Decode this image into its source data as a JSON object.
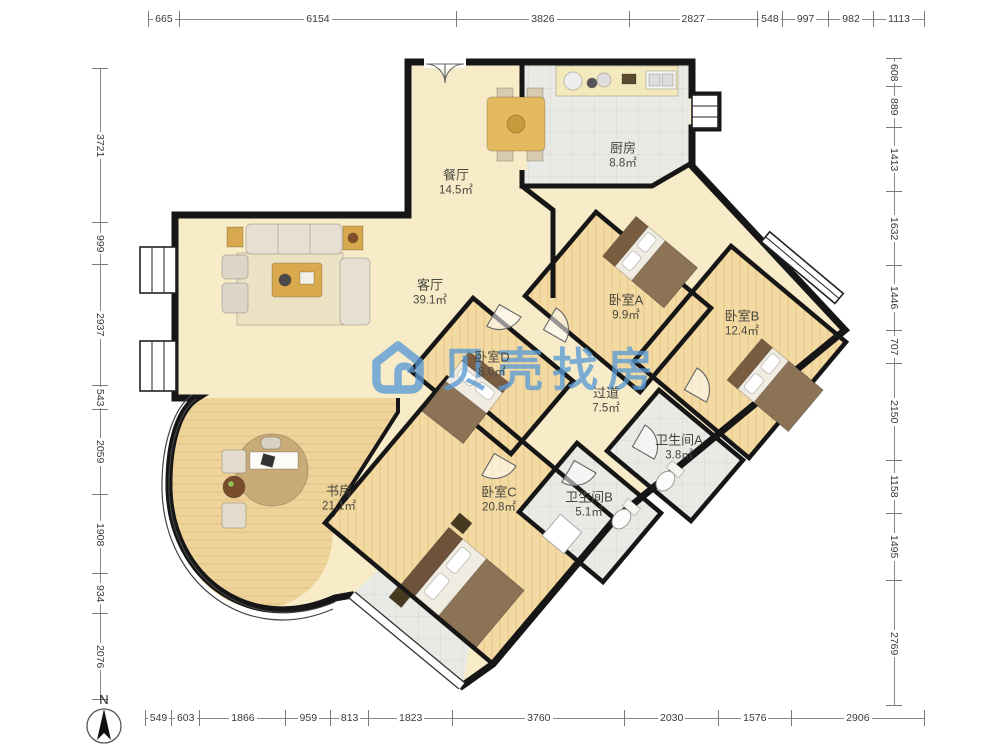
{
  "watermark": {
    "text": "贝壳找房",
    "color": "#5a9bd5"
  },
  "compass": {
    "label": "N"
  },
  "rooms": [
    {
      "id": "dining",
      "name": "餐厅",
      "area": "14.5㎡"
    },
    {
      "id": "kitchen",
      "name": "厨房",
      "area": "8.8㎡"
    },
    {
      "id": "living",
      "name": "客厅",
      "area": "39.1㎡"
    },
    {
      "id": "bedroomA",
      "name": "卧室A",
      "area": "9.9㎡"
    },
    {
      "id": "bedroomB",
      "name": "卧室B",
      "area": "12.4㎡"
    },
    {
      "id": "bedroomD",
      "name": "卧室D",
      "area": "8.0㎡"
    },
    {
      "id": "hallway",
      "name": "过道",
      "area": "7.5㎡"
    },
    {
      "id": "bathA",
      "name": "卫生间A",
      "area": "3.8㎡"
    },
    {
      "id": "bathB",
      "name": "卫生间B",
      "area": "5.1㎡"
    },
    {
      "id": "bedroomC",
      "name": "卧室C",
      "area": "20.8㎡"
    },
    {
      "id": "study",
      "name": "书房",
      "area": "21.1㎡"
    }
  ],
  "rulers": {
    "top": [
      665,
      6154,
      3826,
      2827,
      548,
      997,
      982,
      1113
    ],
    "bottom": [
      549,
      603,
      1866,
      959,
      813,
      1823,
      3760,
      2030,
      1576,
      2906
    ],
    "left": [
      3721,
      999,
      2937,
      543,
      2059,
      1908,
      934,
      2076
    ],
    "right": [
      608,
      889,
      1413,
      1632,
      1446,
      707,
      2150,
      1158,
      1495,
      2769
    ]
  },
  "colors": {
    "wall": "#161616",
    "floor_main": "#f8ecc8",
    "floor_wood": "#f3d9a2",
    "floor_tile": "#e8e8e4",
    "watermark_blue": "#5a9bd5"
  }
}
